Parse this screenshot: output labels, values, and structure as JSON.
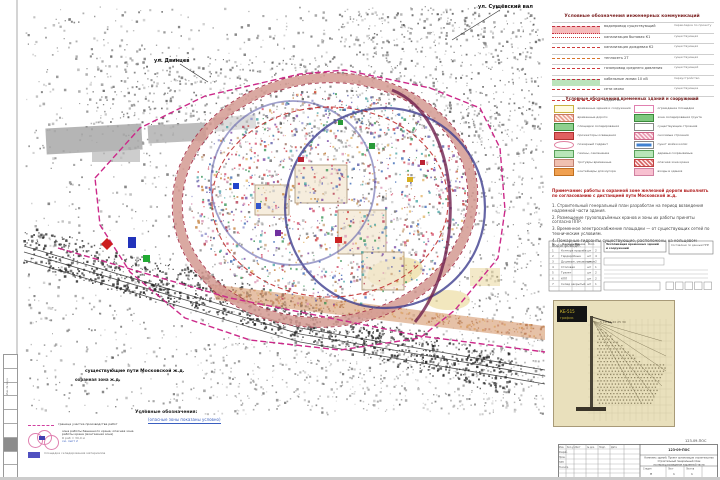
{
  "map": {
    "callout_top": "ул. Сущёвский вал",
    "callout_left": "ул. Двинцев",
    "rail_note_1": "существующие пути Московской ж.д.",
    "rail_note_2": "охранная зона ж.д.",
    "colors": {
      "road_loop": "#d49a92",
      "crane_zone": "#3f3f8f",
      "boundary": "#cc2a8a",
      "danger": "#c03030"
    }
  },
  "utilities_table": {
    "title": "Условные обозначения инженерных коммуникаций",
    "rows": [
      {
        "sample": "pink-band",
        "label": "водопровод существующий",
        "note": "перекладка по проекту"
      },
      {
        "sample": "red-dashdot",
        "label": "канализация бытовая К1",
        "note": "существующая"
      },
      {
        "sample": "red-dash",
        "label": "канализация дождевая К2",
        "note": "существующая"
      },
      {
        "sample": "orange-dash",
        "label": "теплосеть 2Т",
        "note": "существующая"
      },
      {
        "sample": "red-dash",
        "label": "газопровод среднего давления",
        "note": "существующий"
      },
      {
        "sample": "green-band",
        "label": "кабельные линии 10 кВ",
        "note": "переустройство"
      },
      {
        "sample": "red-dash",
        "label": "сети связи",
        "note": "существующие"
      },
      {
        "sample": "red-dash",
        "label": "водосток",
        "note": "существующий"
      }
    ]
  },
  "site_legend": {
    "title": "Условные обозначения временных зданий и сооружений",
    "left": [
      {
        "swatch": "outline-yellow",
        "label": "временные здания и сооружения"
      },
      {
        "swatch": "salmon-hatch",
        "label": "временные дороги"
      },
      {
        "swatch": "green-sq",
        "label": "площадки складирования"
      },
      {
        "swatch": "red-sq",
        "label": "прожекторы освещения"
      },
      {
        "swatch": "circle-pink",
        "label": "пожарный гидрант"
      },
      {
        "swatch": "green-rect",
        "label": "газоны, озеленение"
      },
      {
        "swatch": "salmon-rect",
        "label": "тротуары временные"
      },
      {
        "swatch": "orange-rect",
        "label": "контейнеры для мусора"
      }
    ],
    "right": [
      {
        "swatch": "pink-outline",
        "label": "ограждение площадки"
      },
      {
        "swatch": "green-fill",
        "label": "зона складирования грунта"
      },
      {
        "swatch": "white-rect",
        "label": "существующие строения"
      },
      {
        "swatch": "pink-hatch",
        "label": "сносимые строения"
      },
      {
        "swatch": "blue-dot",
        "label": "пункт мойки колёс"
      },
      {
        "swatch": "green-rect",
        "label": "деревья сохраняемые"
      },
      {
        "swatch": "red-hatch",
        "label": "опасная зона крана"
      },
      {
        "swatch": "pink-small",
        "label": "входы в здания"
      }
    ]
  },
  "notes": {
    "warning": "Примечание: работы в охранной зоне железной дороги выполнять по согласованию с дистанцией пути Московской ж.д.",
    "paragraphs": [
      "1. Строительный генеральный план разработан на период возведения надземной части здания.",
      "2. Размещение грузоподъёмных кранов и зоны их работы приняты согласно ППР.",
      "3. Временное электроснабжение площадки — от существующих сетей по техническим условиям.",
      "4. Пожарные гидранты существующие, расположены на кольцевом водопроводе."
    ]
  },
  "explication": {
    "title": "Экспликация временных зданий и сооружений",
    "headers": [
      "№",
      "Наименование",
      "Ед.",
      "Кол."
    ],
    "rows": [
      [
        "1",
        "Контора прораба",
        "шт",
        "2"
      ],
      [
        "2",
        "Гардеробные",
        "шт",
        "4"
      ],
      [
        "3",
        "Душевые, умывальные",
        "шт",
        "2"
      ],
      [
        "4",
        "Столовая",
        "шт",
        "1"
      ],
      [
        "5",
        "Туалет",
        "шт",
        "2"
      ],
      [
        "6",
        "КПП",
        "шт",
        "2"
      ],
      [
        "7",
        "Склад закрытый",
        "шт",
        "1"
      ]
    ],
    "side_note": "Составлено по данным ППР"
  },
  "crane_inset": {
    "badge_line1": "КБ-515",
    "badge_line2": "график",
    "radii_labels": "5  10  15  20  25  30"
  },
  "title_block": {
    "doc_number": "123-09-ПОС",
    "row_labels": [
      "Изм.",
      "Кол.уч.",
      "Лист",
      "№ док.",
      "Подп.",
      "Дата"
    ],
    "roles": [
      "Разраб.",
      "Пров.",
      "ГИП",
      "Н.контр."
    ],
    "project_lines": [
      "Комплекс зданий. Проект организации строительства",
      "Строительный генеральный план",
      "на период возведения надземной части"
    ],
    "stage_label": "Стадия",
    "sheet_label": "Лист",
    "sheets_label": "Листов",
    "stage": "П",
    "sheet": "1",
    "sheets": "1"
  },
  "side_stamp": {
    "label": "Инв. № подл."
  },
  "bottom_legend": {
    "heading": "Условные обозначения:",
    "subheading": "(опасные зоны показаны условно)",
    "col1": [
      {
        "swatch": "magenta-dash",
        "label": "граница участка производства работ"
      },
      {
        "swatch": "pink-circles",
        "label": "зона работы башенного крана; опасная зона работы крана (монтажная зона)",
        "sub": "R раб = 30,0 м",
        "link": "см. лист 2"
      },
      {
        "swatch": "blue-rect",
        "label": "площадка складирования материалов"
      },
      {
        "swatch": "orange-hatch",
        "label": "бытовой городок"
      },
      {
        "swatch": "brick-hatch",
        "label": "временная автодорога"
      }
    ],
    "col2": [
      {
        "swatch": "blue-square",
        "label": "пункт мойки колёс автотранспорта"
      },
      {
        "swatch": "orange-band",
        "label": "временное ограждение строительной площадки",
        "sub": "с козырьком и тротуаром",
        "extra": "знаки безопасности — по ГОСТ 12.4.026"
      }
    ],
    "col3": [
      {
        "swatch": "gray-hatch",
        "label": "существующие здания и сооружения"
      },
      {
        "swatch": "lilac-rect",
        "label": "проектируемое здание",
        "sub": "(надземная часть)"
      },
      {
        "swatch": "orange-rect",
        "label": "площадка разгрузки автотранспорта"
      },
      {
        "swatch": "purple-rect",
        "label": "временные здания и сооружения"
      }
    ]
  }
}
